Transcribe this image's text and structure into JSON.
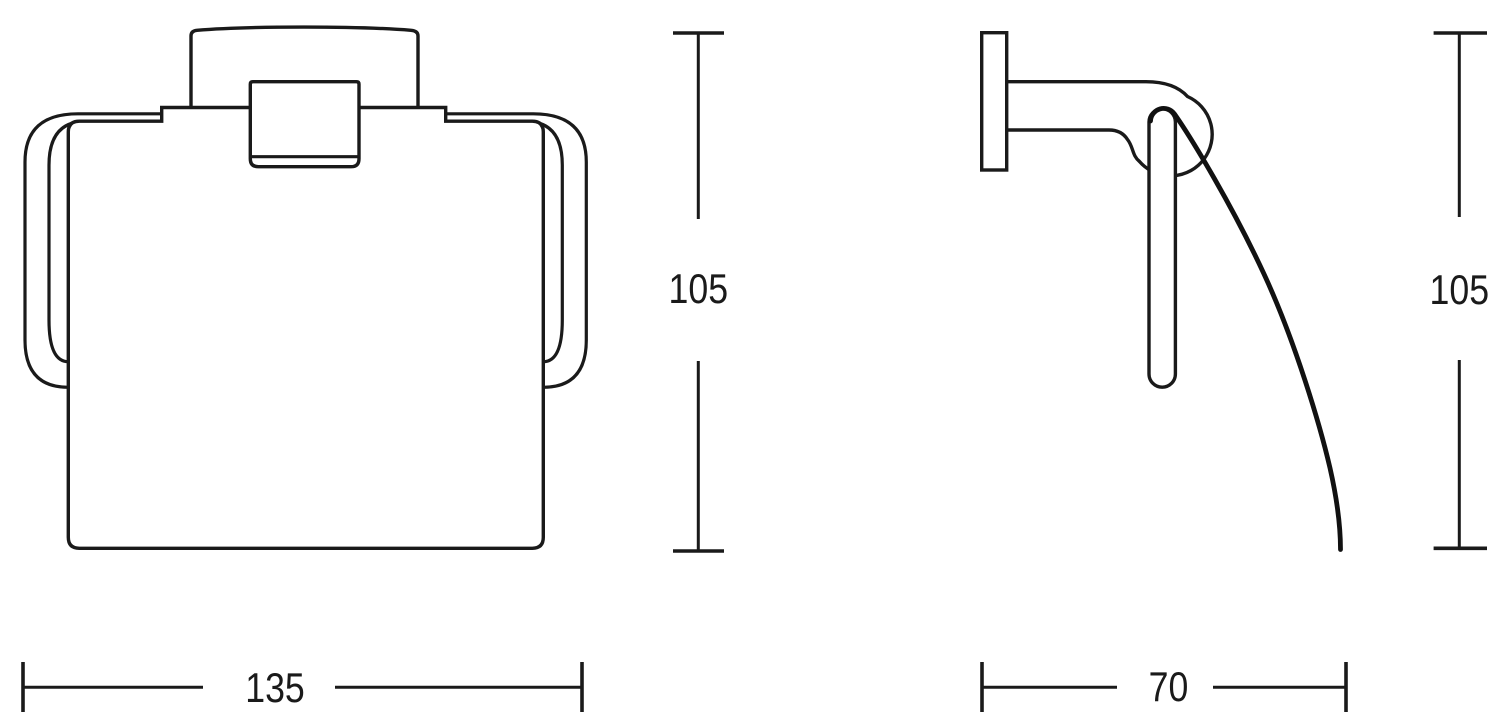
{
  "page": {
    "background": "#ffffff",
    "line_color": "#1a1a1a"
  },
  "dimensions": {
    "front_height": "105",
    "front_width": "135",
    "side_height": "105",
    "side_depth": "70"
  }
}
